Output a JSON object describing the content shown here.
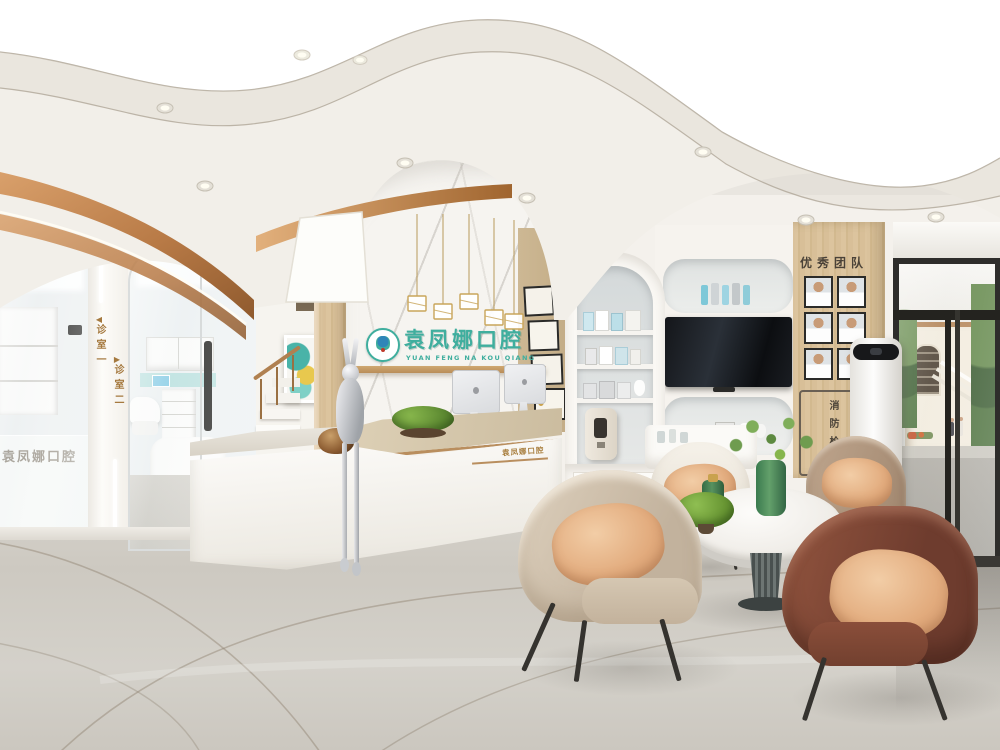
{
  "brand": {
    "logo_zh": "袁凤娜口腔",
    "logo_en": "YUAN FENG NA KOU QIANG",
    "glass_text": "袁凤娜口腔",
    "desk_text": "袁凤娜口腔"
  },
  "signs": {
    "room1_arrow": "◀",
    "room1": "诊室一",
    "room2_arrow": "▶",
    "room2": "诊室二",
    "team_title": "优秀团队",
    "fire_hydrant": "消防栓"
  },
  "colors": {
    "brand_teal": "#3fae9e",
    "copper": "#c07c46",
    "sign_gold": "#a5793f",
    "wood": "#d8c19c",
    "floor_gray": "#cfccc4"
  }
}
